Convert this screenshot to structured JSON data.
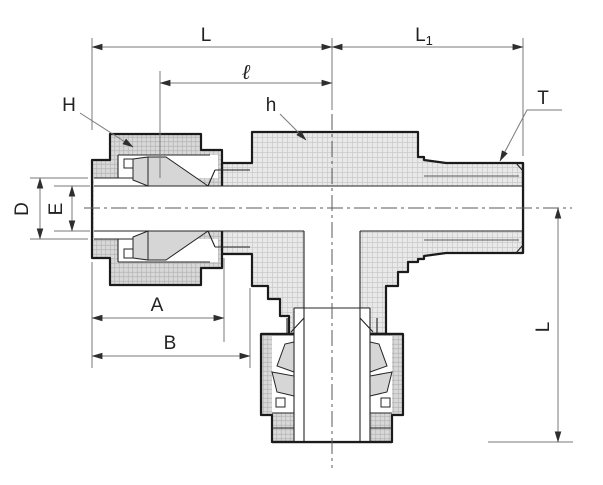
{
  "dims": {
    "L": "L",
    "L1_base": "L",
    "L1_sub": "1",
    "l": "ℓ",
    "H": "H",
    "h": "h",
    "T": "T",
    "D": "D",
    "E": "E",
    "A": "A",
    "B": "B",
    "L_vertical": "L"
  },
  "colors": {
    "outline": "#1b1b1b",
    "internal_line": "#242424",
    "dimension_line": "#7a7a7a",
    "arrow": "#2e2e2e",
    "body_fill": "#e9e9e9",
    "body_hatch": "#c9c9c9",
    "nut_fill": "#d9d9d9",
    "nut_hatch": "#b3b3b3",
    "ferrule_fill": "#d6d6d6",
    "background": "#ffffff",
    "text": "#222222"
  }
}
